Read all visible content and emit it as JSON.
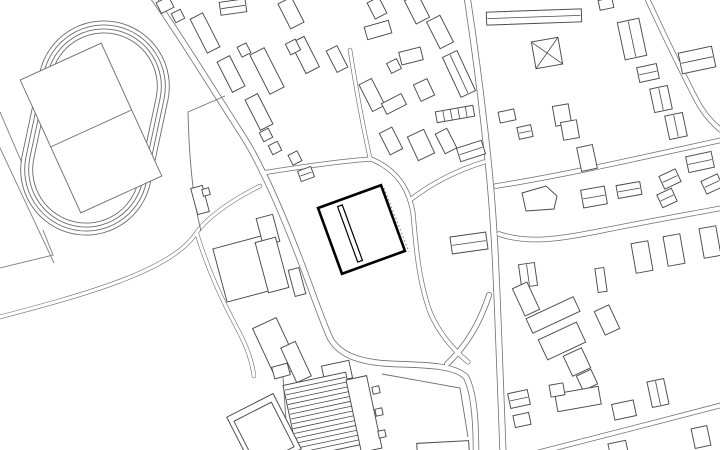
{
  "meta": {
    "description": "architectural site plan, monochrome line drawing",
    "canvas": {
      "width": 720,
      "height": 450
    },
    "colors": {
      "background": "#ffffff",
      "building_stroke": "#4a4a4a",
      "road_stroke": "#6f6f6f",
      "track_stroke": "#6b6b6b",
      "highlight_stroke": "#000000",
      "dotted_stroke": "#8a8a8a"
    }
  },
  "plan": {
    "track": {
      "cx": 95,
      "cy": 128,
      "angle": 12,
      "rings": [
        [
          131,
          216
        ],
        [
          123,
          208
        ],
        [
          115,
          200
        ],
        [
          107,
          192
        ]
      ],
      "infield": {
        "cx": 91,
        "cy": 128,
        "w": 89,
        "h": 146,
        "a": -24.5
      },
      "divider": [
        50.5,
        147,
        131.5,
        110
      ]
    },
    "field_lines": [
      "M0,148 L54,263",
      "M0,112 L40,205",
      "M0,268 L53,255 L43,230"
    ],
    "roads": [
      {
        "d": "M152,-4 C178,32 210,85 243,136 C262,166 283,215 301,262 C312,291 320,315 330,338 C340,356 362,363 395,364 C430,365 455,366 466,377 C474,392 476,420 476,452",
        "c": 6.4,
        "f": 4.8
      },
      {
        "d": "M467,-4 C476,55 484,120 489,170 C494,220 496,270 498,320 C500,370 502,415 503,452",
        "c": 7.0,
        "f": 5.4
      },
      {
        "d": "M447,364 C462,350 472,335 480,318 C484,309 487,302 489,295",
        "c": 6.0,
        "f": 4.4
      },
      {
        "d": "M262,173 C300,167 340,161 371,159",
        "c": 5.0,
        "f": 3.6
      },
      {
        "d": "M371,159 C398,170 409,190 413,213 C416,248 419,282 430,312 C440,336 456,352 468,362",
        "c": 5.0,
        "f": 3.6
      },
      {
        "d": "M410,200 C432,183 458,170 484,162",
        "c": 5.0,
        "f": 3.6
      },
      {
        "d": "M370,158 C362,122 356,88 350,50",
        "c": 4.4,
        "f": 3.1
      },
      {
        "d": "M496,186 C560,176 640,158 722,140",
        "c": 5.5,
        "f": 4.0
      },
      {
        "d": "M499,234 C528,244 560,239 600,231 C650,221 690,214 722,208",
        "c": 5.5,
        "f": 4.0
      },
      {
        "d": "M646,-4 C663,33 682,72 697,101 C704,114 713,124 722,131",
        "c": 5.5,
        "f": 4.0
      },
      {
        "d": "M536,453 C600,437 660,421 722,405",
        "c": 5.5,
        "f": 4.0
      },
      {
        "d": "M260,186 C228,202 206,218 194,236 C168,272 80,296 -4,318",
        "c": 4.4,
        "f": 3.2
      },
      {
        "d": "M197,234 C208,270 222,300 238,330 C248,349 252,362 254,376",
        "c": 4.4,
        "f": 3.2
      }
    ],
    "single_lines": [
      "M225,96 L188,112 C189,155 192,196 201,231",
      "M382,374 L460,388 L468,437",
      "M240,424 Q259,442 277,419",
      "M283,377 L288,450"
    ],
    "buildings": [
      [
        165,
        5,
        14,
        12,
        -27,
        ""
      ],
      [
        178,
        16,
        10,
        10,
        -27,
        ""
      ],
      [
        205,
        33,
        14,
        38,
        -27,
        ""
      ],
      [
        233,
        7,
        26,
        13,
        -8,
        "L"
      ],
      [
        244,
        50,
        10,
        11,
        -27,
        ""
      ],
      [
        291,
        13,
        15,
        28,
        -27,
        ""
      ],
      [
        267,
        71,
        16,
        44,
        -27,
        ""
      ],
      [
        305,
        55,
        15,
        34,
        -27,
        ""
      ],
      [
        231,
        74,
        14,
        34,
        -27,
        ""
      ],
      [
        259,
        112,
        14,
        34,
        -27,
        ""
      ],
      [
        266,
        135,
        10,
        10,
        -27,
        ""
      ],
      [
        275,
        148,
        10,
        10,
        -27,
        ""
      ],
      [
        295,
        158,
        10,
        11,
        -27,
        ""
      ],
      [
        306,
        174,
        14,
        11,
        -20,
        "L"
      ],
      [
        293,
        47,
        11,
        12,
        -27,
        ""
      ],
      [
        337,
        59,
        12,
        24,
        -27,
        ""
      ],
      [
        378,
        30,
        25,
        13,
        -16,
        ""
      ],
      [
        377,
        8,
        13,
        18,
        -27,
        ""
      ],
      [
        417,
        9,
        15,
        26,
        -27,
        ""
      ],
      [
        440,
        32,
        15,
        30,
        -27,
        ""
      ],
      [
        459,
        74,
        16,
        44,
        -25,
        "L"
      ],
      [
        411,
        56,
        22,
        13,
        -14,
        ""
      ],
      [
        394,
        66,
        11,
        11,
        -27,
        ""
      ],
      [
        372,
        95,
        14,
        30,
        -27,
        ""
      ],
      [
        394,
        104,
        22,
        12,
        -27,
        ""
      ],
      [
        424,
        90,
        15,
        18,
        -25,
        ""
      ],
      [
        455,
        114,
        38,
        11,
        -10,
        "C"
      ],
      [
        391,
        141,
        14,
        24,
        -27,
        ""
      ],
      [
        421,
        145,
        18,
        26,
        -25,
        ""
      ],
      [
        446,
        141,
        13,
        22,
        -27,
        ""
      ],
      [
        471,
        151,
        26,
        14,
        -18,
        "L"
      ],
      [
        507,
        116,
        16,
        11,
        -12,
        ""
      ],
      [
        525,
        132,
        14,
        12,
        -12,
        "L"
      ],
      [
        200,
        200,
        12,
        27,
        -15,
        ""
      ],
      [
        206,
        192,
        7,
        7,
        -15,
        ""
      ],
      [
        534,
        17,
        95,
        13,
        -2,
        "L"
      ],
      [
        547,
        53,
        27,
        27,
        -10,
        "X"
      ],
      [
        562,
        115,
        16,
        20,
        -10,
        ""
      ],
      [
        570,
        130,
        16,
        18,
        -10,
        ""
      ],
      [
        587,
        158,
        16,
        24,
        -12,
        ""
      ],
      [
        606,
        4,
        14,
        10,
        -12,
        ""
      ],
      [
        632,
        39,
        22,
        38,
        -12,
        "L"
      ],
      [
        648,
        73,
        20,
        15,
        -12,
        "L"
      ],
      [
        661,
        99,
        18,
        24,
        -12,
        "L"
      ],
      [
        676,
        126,
        18,
        24,
        -12,
        "L"
      ],
      [
        700,
        162,
        26,
        16,
        -12,
        "L"
      ],
      [
        697,
        60,
        34,
        21,
        -12,
        "L"
      ],
      [
        594,
        197,
        24,
        18,
        -10,
        "L"
      ],
      [
        629,
        190,
        24,
        13,
        -10,
        "L"
      ],
      [
        667,
        198,
        16,
        14,
        -25,
        "L"
      ],
      [
        670,
        179,
        18,
        14,
        -25,
        "L"
      ],
      [
        712,
        184,
        18,
        14,
        -25,
        "L"
      ],
      [
        642,
        257,
        17,
        30,
        -10,
        ""
      ],
      [
        674,
        250,
        17,
        30,
        -10,
        ""
      ],
      [
        710,
        242,
        17,
        30,
        -10,
        ""
      ],
      [
        528,
        275,
        16,
        23,
        -8,
        "L"
      ],
      [
        601,
        280,
        9,
        24,
        -8,
        ""
      ],
      [
        526,
        299,
        16,
        30,
        -25,
        ""
      ],
      [
        553,
        315,
        52,
        16,
        -25,
        ""
      ],
      [
        562,
        341,
        42,
        22,
        -25,
        ""
      ],
      [
        577,
        362,
        20,
        22,
        -25,
        ""
      ],
      [
        607,
        320,
        16,
        26,
        -25,
        ""
      ],
      [
        587,
        380,
        16,
        16,
        -25,
        ""
      ],
      [
        578,
        399,
        44,
        18,
        -10,
        ""
      ],
      [
        557,
        390,
        14,
        12,
        -10,
        ""
      ],
      [
        519,
        399,
        20,
        15,
        -12,
        "L"
      ],
      [
        522,
        420,
        16,
        12,
        -12,
        ""
      ],
      [
        624,
        410,
        22,
        16,
        -12,
        ""
      ],
      [
        658,
        393,
        17,
        26,
        -12,
        "L"
      ],
      [
        618,
        448,
        18,
        12,
        -12,
        ""
      ],
      [
        443,
        448,
        52,
        12,
        -3,
        ""
      ],
      [
        701,
        437,
        16,
        20,
        -12,
        ""
      ],
      [
        469,
        243,
        36,
        17,
        -8,
        "L"
      ],
      [
        248,
        268,
        58,
        55,
        -15,
        ""
      ],
      [
        268,
        230,
        17,
        28,
        -15,
        ""
      ],
      [
        272,
        265,
        21,
        52,
        -15,
        ""
      ],
      [
        297,
        282,
        11,
        27,
        -15,
        ""
      ],
      [
        276,
        348,
        26,
        55,
        -25,
        ""
      ],
      [
        296,
        362,
        16,
        38,
        -25,
        ""
      ],
      [
        337,
        372,
        28,
        18,
        -12,
        ""
      ],
      [
        322,
        415,
        64,
        74,
        -12,
        "H"
      ],
      [
        364,
        414,
        21,
        74,
        -12,
        ""
      ],
      [
        376,
        390,
        7,
        7,
        -12,
        ""
      ],
      [
        379,
        412,
        7,
        7,
        -12,
        ""
      ],
      [
        382,
        434,
        7,
        7,
        -12,
        ""
      ],
      [
        281,
        371,
        16,
        12,
        -15,
        ""
      ],
      [
        264,
        433,
        52,
        62,
        -27,
        ""
      ],
      [
        264,
        434,
        42,
        50,
        -27,
        ""
      ]
    ],
    "polygons": [
      "522,193 546,186 557,196 554,209 526,211"
    ],
    "dotted_lines": [
      "M384,188 L409,252"
    ],
    "highlight": {
      "square": {
        "cx": 361.5,
        "cy": 229.5,
        "w": 67,
        "h": 70,
        "a": -20
      },
      "bar": {
        "cx": 350,
        "cy": 233.5,
        "w": 5,
        "h": 59,
        "a": -20
      }
    }
  }
}
